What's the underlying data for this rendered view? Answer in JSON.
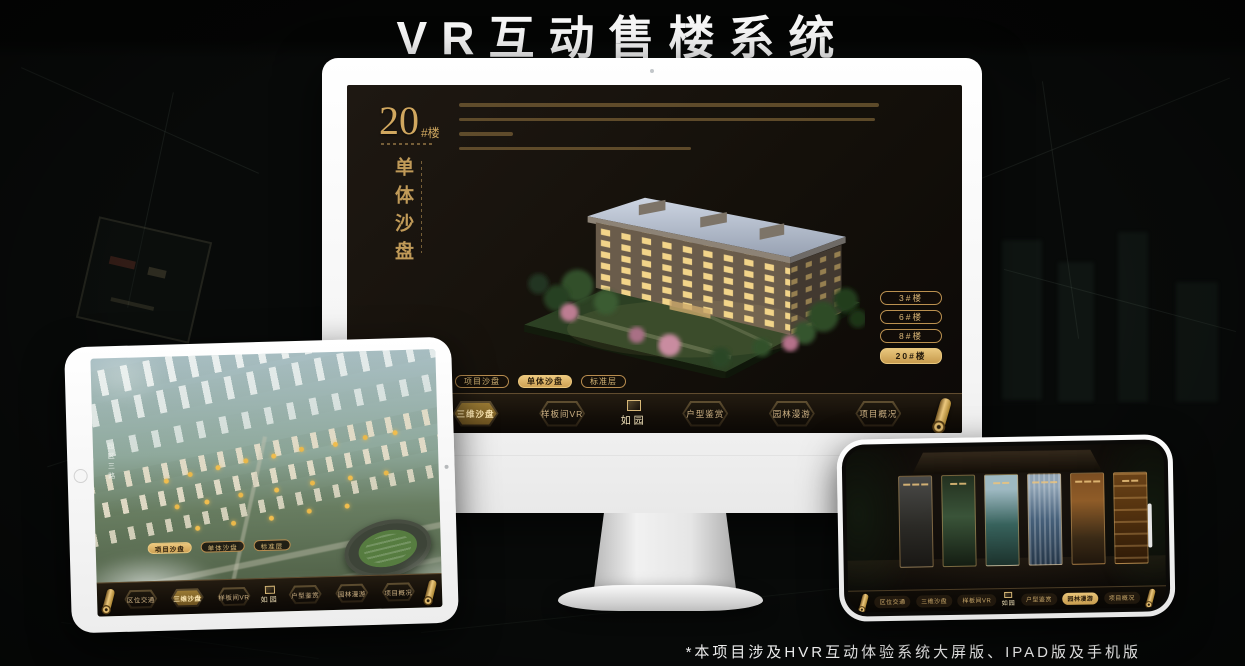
{
  "page": {
    "title": "VR互动售楼系统",
    "footnote": "*本项目涉及HVR互动体验系统大屏版、IPAD版及手机版"
  },
  "colors": {
    "gold": "#c9a063",
    "gold_bright": "#ecc87e",
    "screen_bg": "#14100a",
    "title_color": "#f7f7f7"
  },
  "icons": {
    "scroll_icon": "gold-scroll-roll",
    "seal_icon": "square-gold-seal"
  },
  "monitor": {
    "heading": {
      "number": "20",
      "suffix": "#楼",
      "subtitle_vertical": "单体沙盘"
    },
    "floor_buttons": [
      {
        "label": "3#楼",
        "active": false
      },
      {
        "label": "6#楼",
        "active": false
      },
      {
        "label": "8#楼",
        "active": false
      },
      {
        "label": "20#楼",
        "active": true
      }
    ],
    "view_tabs": [
      {
        "label": "项目沙盘",
        "active": false
      },
      {
        "label": "单体沙盘",
        "active": true
      },
      {
        "label": "标准层",
        "active": false
      }
    ],
    "nav": {
      "logo": "如园",
      "items": [
        {
          "label": "区位交通",
          "active": false
        },
        {
          "label": "三维沙盘",
          "active": true
        },
        {
          "label": "样板间VR",
          "active": false
        },
        {
          "label": "户型鉴赏",
          "active": false
        },
        {
          "label": "园林漫游",
          "active": false
        },
        {
          "label": "项目概况",
          "active": false
        }
      ]
    }
  },
  "tablet": {
    "road_label": "园区三路",
    "view_tabs": [
      {
        "label": "项目沙盘",
        "active": true
      },
      {
        "label": "单体沙盘",
        "active": false
      },
      {
        "label": "标准层",
        "active": false
      }
    ],
    "nav": {
      "logo": "如园",
      "items": [
        {
          "label": "区位交通",
          "active": false
        },
        {
          "label": "三维沙盘",
          "active": true
        },
        {
          "label": "样板间VR",
          "active": false
        },
        {
          "label": "户型鉴赏",
          "active": false
        },
        {
          "label": "园林漫游",
          "active": false
        },
        {
          "label": "项目概况",
          "active": false
        }
      ]
    }
  },
  "phone": {
    "nav": {
      "logo": "如园",
      "items": [
        {
          "label": "区位交通",
          "active": false
        },
        {
          "label": "三维沙盘",
          "active": false
        },
        {
          "label": "样板间VR",
          "active": false
        },
        {
          "label": "户型鉴赏",
          "active": false
        },
        {
          "label": "园林漫游",
          "active": true
        },
        {
          "label": "项目概况",
          "active": false
        }
      ]
    }
  }
}
